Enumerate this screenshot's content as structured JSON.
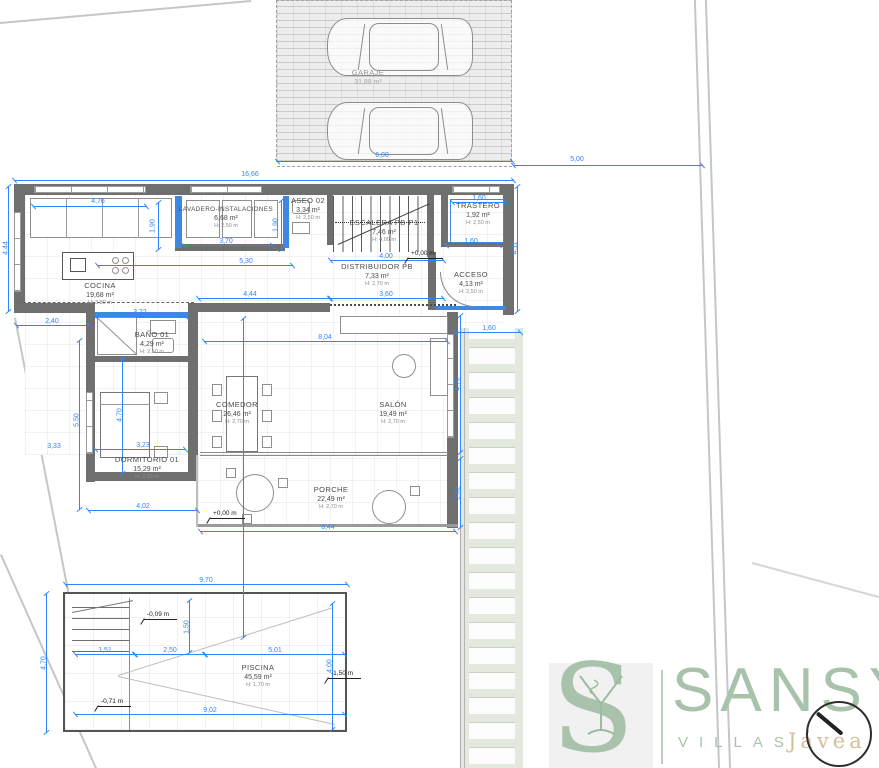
{
  "rooms": [
    {
      "id": "garaje",
      "name": "GARAJE",
      "area": "31,88 m²",
      "height": ""
    },
    {
      "id": "lavadero",
      "name": "LAVADERO-INSTALACIONES",
      "area": "6,68 m²",
      "height": "H: 2,50 m"
    },
    {
      "id": "aseo02",
      "name": "ASEO 02",
      "area": "3,34 m²",
      "height": "H: 2,50 m"
    },
    {
      "id": "escalera",
      "name": "ESCALERA PB-P1",
      "area": "7,46 m²",
      "height": "H: 4,00 m"
    },
    {
      "id": "trastero",
      "name": "TRASTERO",
      "area": "1,92 m²",
      "height": "H: 2,50 m"
    },
    {
      "id": "acceso",
      "name": "ACCESO",
      "area": "4,13 m²",
      "height": "H: 2,50 m"
    },
    {
      "id": "cocina",
      "name": "COCINA",
      "area": "19,68 m²",
      "height": "H: 3,80 m"
    },
    {
      "id": "distribuidor",
      "name": "DISTRIBUIDOR PB",
      "area": "7,33 m²",
      "height": "H: 2,70 m"
    },
    {
      "id": "bano01",
      "name": "BAÑO 01",
      "area": "4,29 m²",
      "height": "H: 2,50 m"
    },
    {
      "id": "dormitorio01",
      "name": "DORMITORIO 01",
      "area": "15,29 m²",
      "height": "H: 2,50 m"
    },
    {
      "id": "comedor",
      "name": "COMEDOR",
      "area": "26,46 m²",
      "height": "H: 2,70 m"
    },
    {
      "id": "salon",
      "name": "SALÓN",
      "area": "19,49 m²",
      "height": "H: 2,70 m"
    },
    {
      "id": "porche",
      "name": "PORCHE",
      "area": "22,49 m²",
      "height": "H: 2,70 m"
    },
    {
      "id": "piscina",
      "name": "PISCINA",
      "area": "45,59 m²",
      "height": "H: 1,70 m"
    }
  ],
  "dims": [
    "16,66",
    "6,00",
    "5,00",
    "4,76",
    "1,90",
    "1,90",
    "3,70",
    "5,30",
    "4,00",
    "3,60",
    "4,44",
    "1,60",
    "1,60",
    "4,44",
    "4,11",
    "2,40",
    "3,22",
    "8,04",
    "4,70",
    "5,50",
    "3,23",
    "4,02",
    "8,44",
    "1,60",
    "4,70",
    "2,62",
    "9,70",
    "4,70",
    "1,51",
    "2,50",
    "5,01",
    "1,50",
    "4,00",
    "9,02",
    "3,33"
  ],
  "levels": [
    "+0,00 m",
    "+0,00 m",
    "-0,09 m",
    "-0,71 m",
    "-1,50 m"
  ],
  "logo": {
    "initial": "S",
    "brand": "SANSY",
    "tagline": "VILLAS",
    "location": "Jávea"
  },
  "colors": {
    "dimension": "#2e86ff",
    "wall": "#6f6f6f",
    "accent_wall": "#3f87e0",
    "logo_green": "#a9c2ab",
    "logo_tan": "#d4bd98",
    "paver_bg": "#e4e9df"
  }
}
